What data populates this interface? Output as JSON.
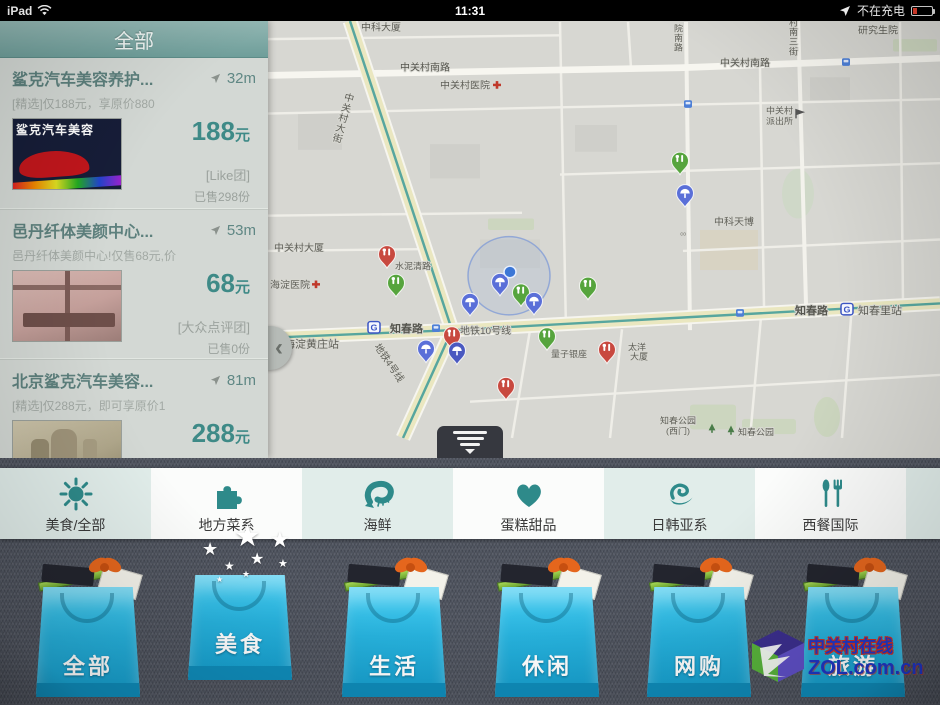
{
  "status_bar": {
    "device": "iPad",
    "time": "11:31",
    "battery_status": "不在充电"
  },
  "sidebar": {
    "header": "全部",
    "deals": [
      {
        "title": "鲨克汽车美容养护...",
        "distance": "32m",
        "subtitle": "[精选]仅188元，享原价880",
        "price": "188",
        "unit": "元",
        "vendor": "[Like团]",
        "sold": "已售298份",
        "thumb_text": "鲨克汽车美容"
      },
      {
        "title": "邑丹纤体美颜中心...",
        "distance": "53m",
        "subtitle": "邑丹纤体美颜中心!仅售68元,价",
        "price": "68",
        "unit": "元",
        "vendor": "[大众点评团]",
        "sold": "已售0份"
      },
      {
        "title": "北京鲨克汽车美容...",
        "distance": "81m",
        "subtitle": "[精选]仅288元，即可享原价1",
        "price": "288",
        "unit": "元"
      }
    ]
  },
  "map": {
    "labels": [
      "中科大厦",
      "中关村南路",
      "中关村医院",
      "中关村南路",
      "研究生院",
      "院南路",
      "村南三街",
      "中关村",
      "派出所",
      "中科天博",
      "中关村大厦",
      "海淀医院",
      "水泥清路",
      "知春路",
      "地铁10号线",
      "海淀黄庄站",
      "地铁4号线",
      "量子银座",
      "太洋",
      "大厦",
      "知春路",
      "知春里站",
      "知春公园",
      "(西门)",
      "知春公园",
      "中关村大街"
    ]
  },
  "categories": [
    {
      "label": "美食/全部",
      "icon": "sun-icon"
    },
    {
      "label": "地方菜系",
      "icon": "puzzle-icon"
    },
    {
      "label": "海鲜",
      "icon": "shrimp-icon"
    },
    {
      "label": "蛋糕甜品",
      "icon": "heart-icon"
    },
    {
      "label": "日韩亚系",
      "icon": "swirl-icon"
    },
    {
      "label": "西餐国际",
      "icon": "cutlery-icon"
    }
  ],
  "bags": [
    {
      "label": "全部",
      "selected": false
    },
    {
      "label": "美食",
      "selected": true
    },
    {
      "label": "生活",
      "selected": false
    },
    {
      "label": "休闲",
      "selected": false
    },
    {
      "label": "网购",
      "selected": false
    },
    {
      "label": "旅游",
      "selected": false
    }
  ],
  "watermark": {
    "site_name": "中关村在线",
    "site_url": "ZOL.com.cn"
  },
  "colors": {
    "accent_teal": "#2e8a8a",
    "price_teal": "#3e8a87",
    "bag_cyan": "#27b2dd",
    "pin_red": "#c8493f",
    "pin_green": "#56a43d",
    "pin_blue": "#5a6fd8"
  }
}
